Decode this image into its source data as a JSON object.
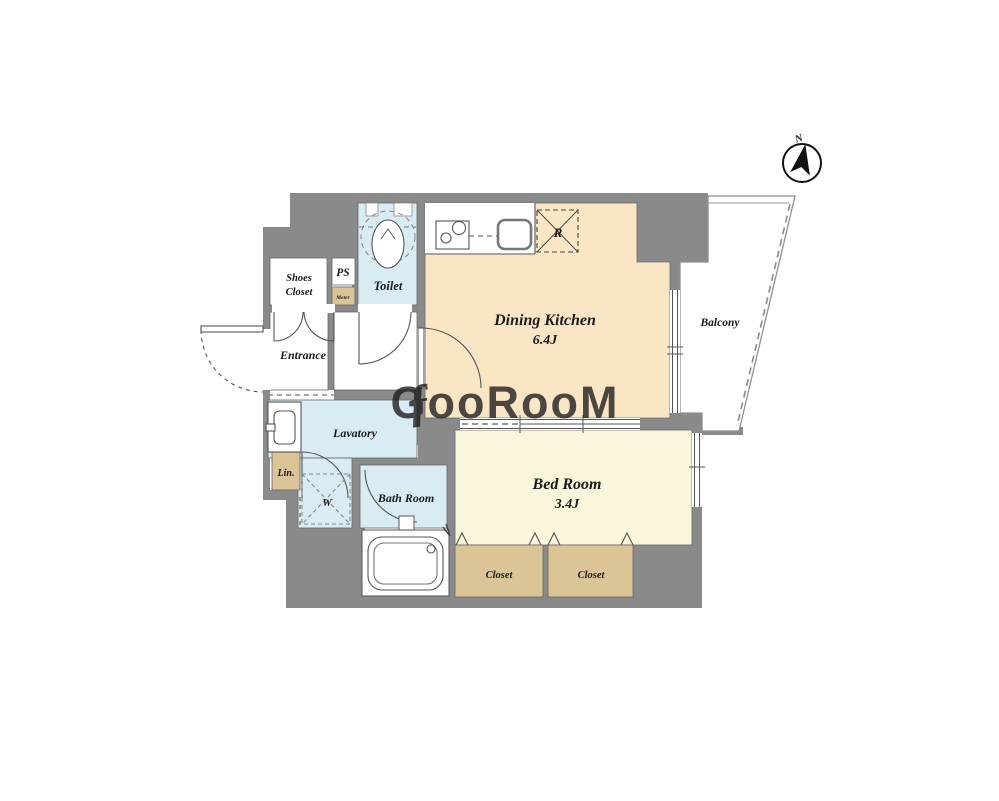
{
  "watermark": {
    "script_prefix": "ƒ",
    "text": "GooRooM"
  },
  "compass": {
    "north_label": "N"
  },
  "rooms": {
    "dining_kitchen": {
      "label": "Dining Kitchen",
      "size": "6.4J"
    },
    "bed_room": {
      "label": "Bed Room",
      "size": "3.4J"
    },
    "balcony": {
      "label": "Balcony"
    },
    "entrance": {
      "label": "Entrance"
    },
    "lavatory": {
      "label": "Lavatory"
    },
    "toilet": {
      "label": "Toilet"
    },
    "bath_room": {
      "label": "Bath Room"
    },
    "shoes_closet": {
      "line1": "Shoes",
      "line2": "Closet"
    },
    "pipe_space": {
      "label": "PS"
    },
    "meter_box": {
      "label": "Meter"
    },
    "linen": {
      "label": "Lin."
    },
    "closet_left": {
      "label": "Closet"
    },
    "closet_right": {
      "label": "Closet"
    }
  },
  "fixtures": {
    "refrigerator_mark": "R",
    "washing_machine_mark": "W"
  },
  "colors": {
    "wall": "#8a8a8a",
    "dining_kitchen_floor": "#fae6c5",
    "bedroom_floor": "#faf6dc",
    "closet_fill": "#dbc496",
    "wet_area_fill": "#d9ecf4",
    "line": "#555555"
  }
}
